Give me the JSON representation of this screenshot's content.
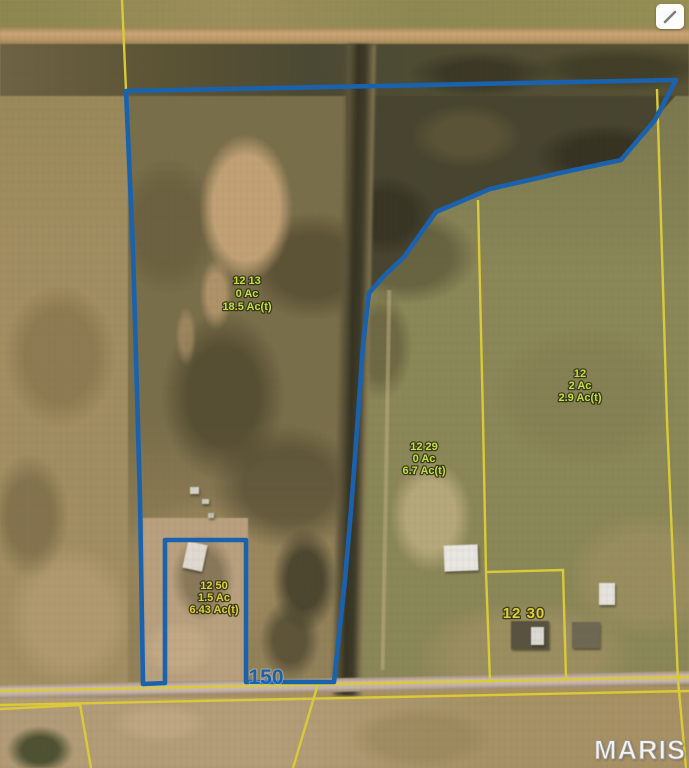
{
  "scene": {
    "kind": "aerial parcel map photo",
    "watermark": "MARIS",
    "road_label": "150",
    "corner_icon": "diagonal-pen",
    "colors": {
      "boundary_blue": "#1b62ae",
      "parcel_yellow": "#d9ca3a",
      "label_green": "#c8dc42",
      "label_gold": "#e2cc38"
    },
    "parcel_labels": [
      {
        "id": "12 13",
        "acres": "0 Ac",
        "total": "18.5 Ac(t)"
      },
      {
        "id": "12 29",
        "acres": "0 Ac",
        "total": "6.7 Ac(t)"
      },
      {
        "id": "12",
        "acres": "2 Ac",
        "total": "2.9 Ac(t)"
      },
      {
        "id": "12 50",
        "acres": "1.5 Ac",
        "total": "6.43 Ac(t)"
      },
      {
        "id": "12 30",
        "acres": "",
        "total": ""
      }
    ]
  }
}
